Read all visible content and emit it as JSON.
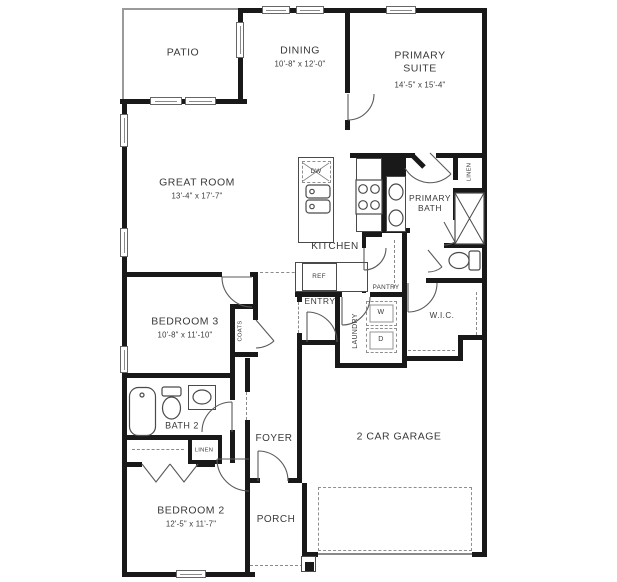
{
  "rooms": {
    "patio": {
      "name": "PATIO"
    },
    "dining": {
      "name": "DINING",
      "dims": "10'-8\" x 12'-0\""
    },
    "primary_suite": {
      "name": "PRIMARY SUITE",
      "dims": "14'-5\" x 15'-4\""
    },
    "great_room": {
      "name": "GREAT ROOM",
      "dims": "13'-4\" x 17'-7\""
    },
    "kitchen": {
      "name": "KITCHEN"
    },
    "primary_bath": {
      "name": "PRIMARY BATH"
    },
    "bedroom3": {
      "name": "BEDROOM 3",
      "dims": "10'-8\" x 11'-10\""
    },
    "bath2": {
      "name": "BATH 2"
    },
    "bedroom2": {
      "name": "BEDROOM 2",
      "dims": "12'-5\" x 11'-7\""
    },
    "entry": {
      "name": "ENTRY"
    },
    "foyer": {
      "name": "FOYER"
    },
    "porch": {
      "name": "PORCH"
    },
    "garage": {
      "name": "2 CAR GARAGE"
    },
    "wic": {
      "name": "W.I.C."
    },
    "laundry": {
      "name": "LAUNDRY"
    },
    "pantry": {
      "name": "PANTRY"
    }
  },
  "closets": {
    "coats": "COATS",
    "linen_primary": "LINEN",
    "linen_hall": "LINEN"
  },
  "appliances": {
    "ref": "REF",
    "dw": "DW",
    "washer": "W",
    "dryer": "D"
  }
}
